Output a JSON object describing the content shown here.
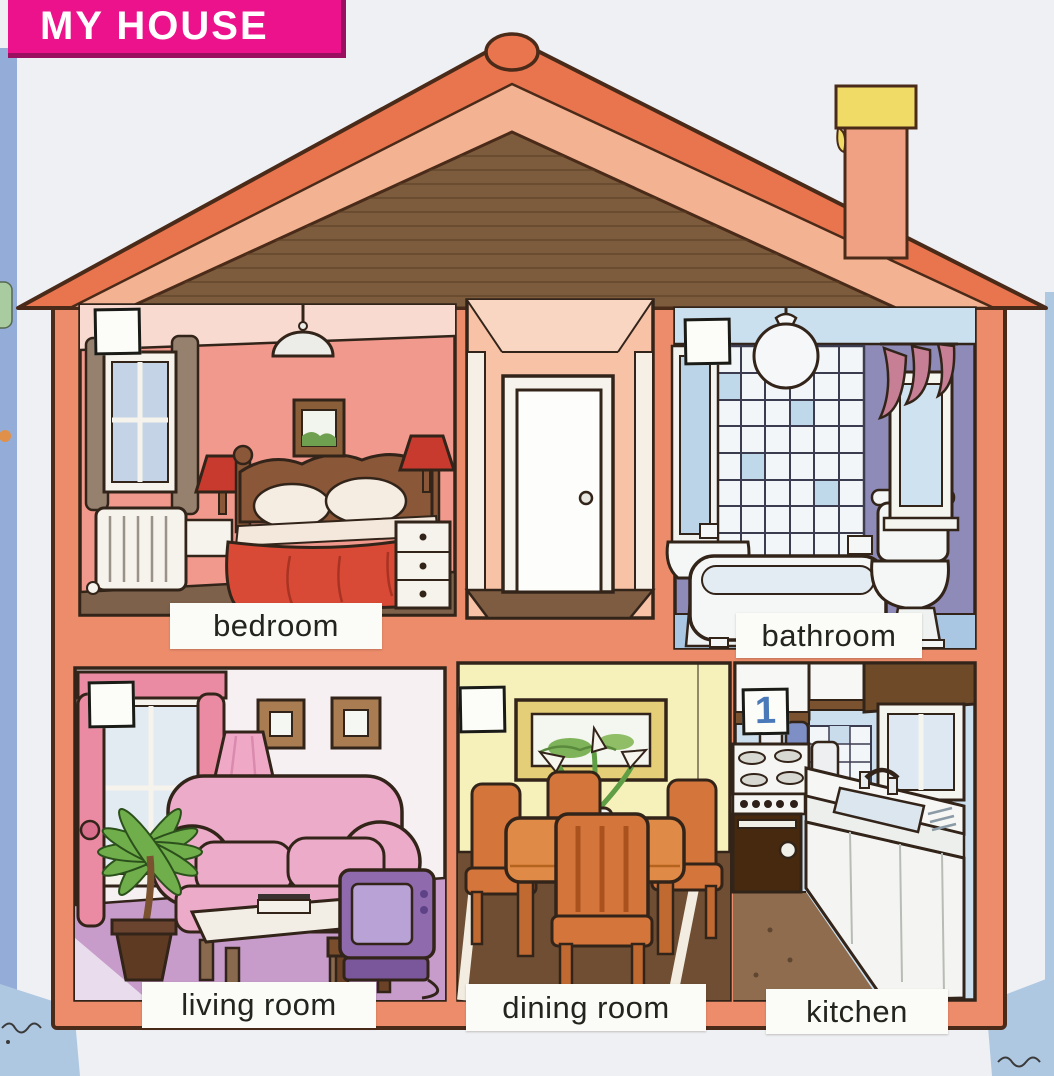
{
  "title": "MY HOUSE",
  "rooms": {
    "bedroom": {
      "label": "bedroom",
      "answer": ""
    },
    "bathroom": {
      "label": "bathroom",
      "answer": ""
    },
    "living_room": {
      "label": "living room",
      "answer": ""
    },
    "dining_room": {
      "label": "dining room",
      "answer": ""
    },
    "kitchen": {
      "label": "kitchen",
      "answer": "1"
    }
  },
  "colors": {
    "banner_bg": "#EC128C",
    "banner_text": "#FFFFFF",
    "page_bg": "#EFF0F4",
    "margin_blue": "#93ADD8",
    "roof_outer": "#E9754F",
    "roof_inner": "#F3B292",
    "attic_brown": "#7D5C3E",
    "house_wall": "#ED8C6B",
    "chimney_cap_yellow": "#F0DB66",
    "bedroom_wall": "#F1998D",
    "hall_wall": "#F7C2A6",
    "bathroom_wall": "#8E8BB8",
    "living_room_wall": "#F7F0F3",
    "dining_room_wall": "#F6F0BA",
    "kitchen_wall": "#CBDFEE",
    "label_bg": "#FBFBF7",
    "label_text": "#24241E",
    "answer_ink": "#4A79B9"
  }
}
